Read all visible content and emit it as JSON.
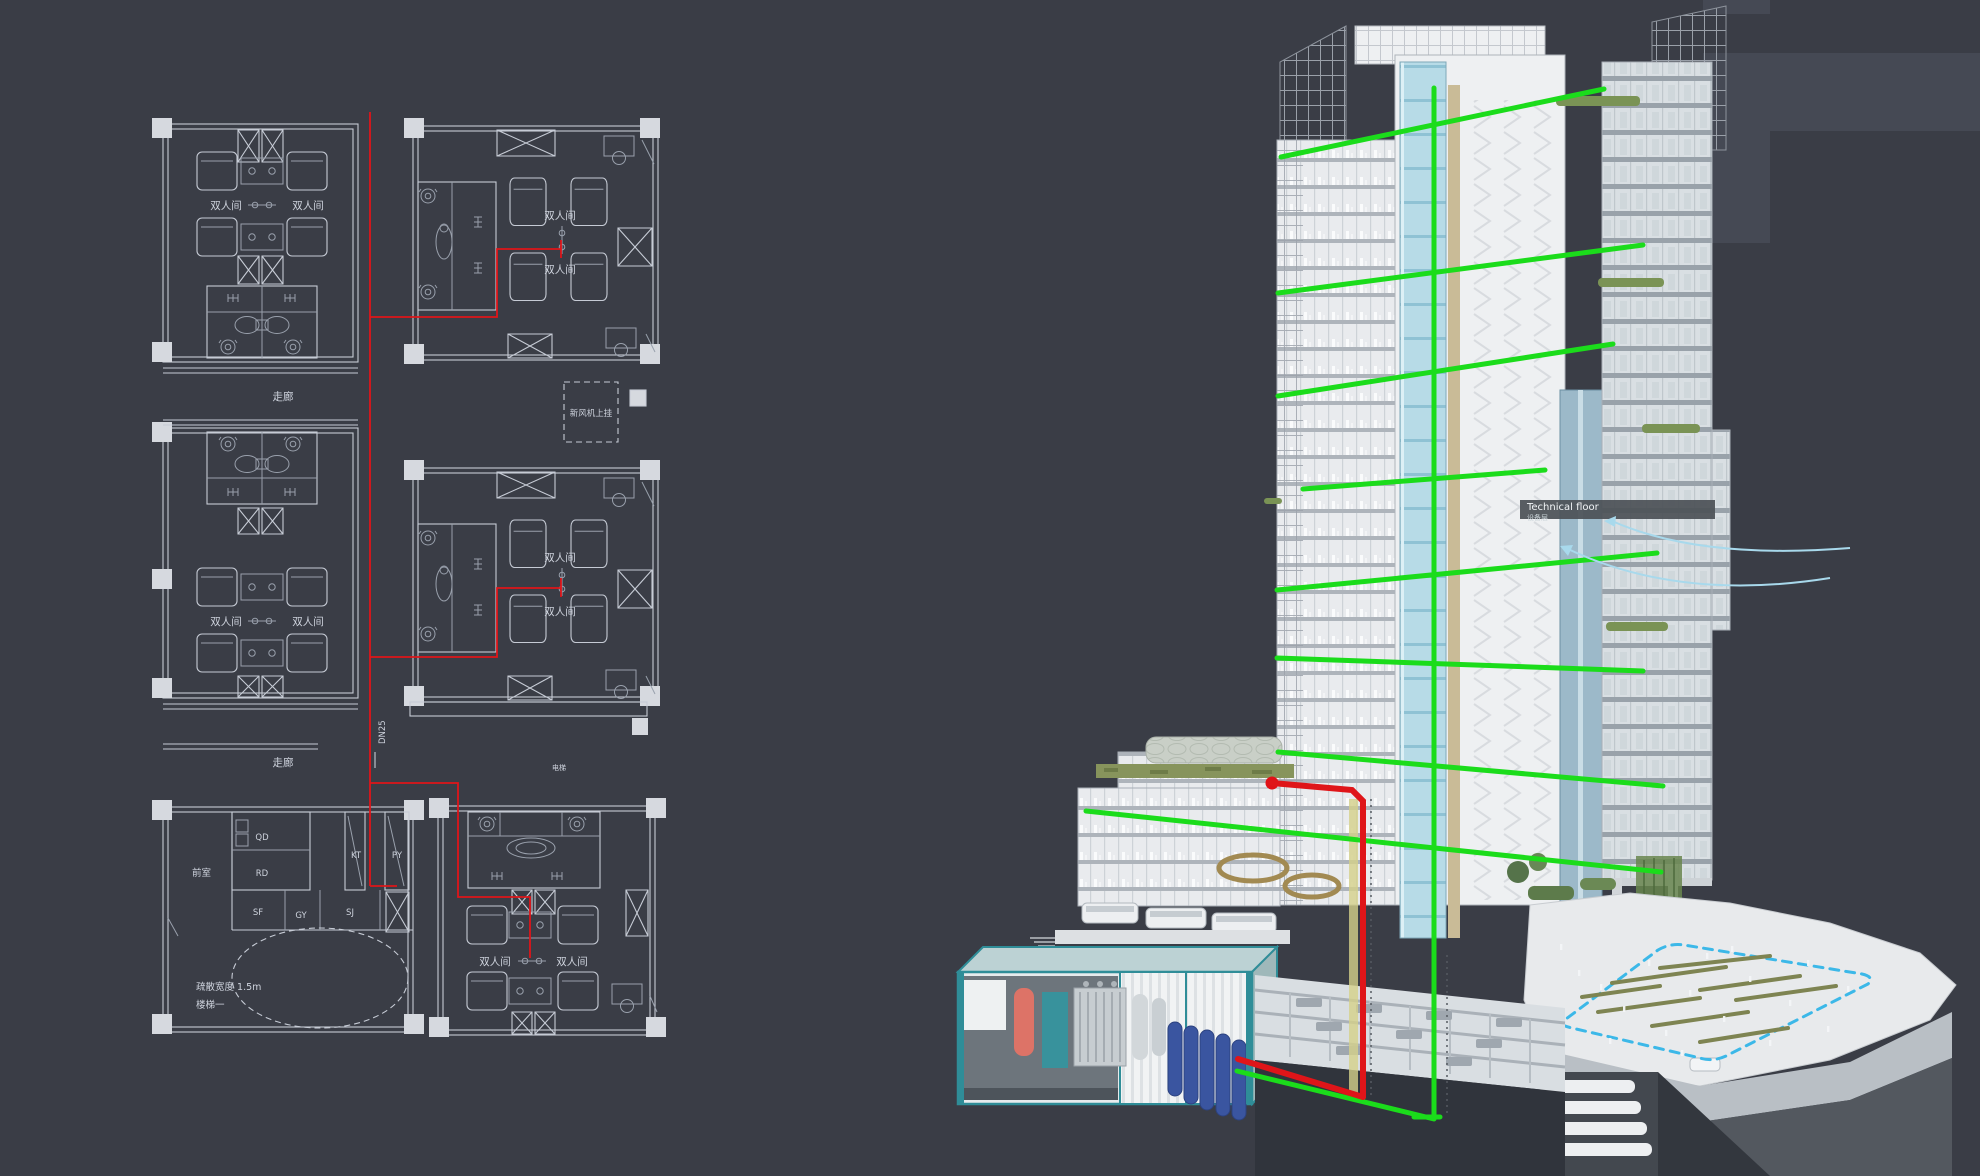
{
  "theme": {
    "bg": "#3a3d46",
    "plan_line": "#c6cbd5",
    "plan_dim": "#99a0ac",
    "plan_fill": "#d6d9df",
    "plan_text": "#ced3dd",
    "pipe_red": "#df1519",
    "pipe_green": "#1bdc1b",
    "boundary_cyan": "#3cb8e8",
    "arrow_blue": "#a8d9ec",
    "bench_olive": "#7e8452",
    "tech_band": "#4c5257",
    "container_teal": "#2f8d98",
    "shaft_blue": "#b9dce8",
    "shaft_yellow": "#d5d18a",
    "tank_red": "#dd7367",
    "cylinder_blue": "#3a55a0"
  },
  "floor_plan": {
    "double_room": "双人间",
    "corridor": "走廊",
    "pipe_size": "DN25",
    "fresh_air": "新风机上挂",
    "evac_width": "疏散宽度 1.5m",
    "stair": "楼梯一",
    "elevator": "电梯",
    "rooms": {
      "front_room": "前室",
      "qd": "QD",
      "rd": "RD",
      "sf": "SF",
      "gy": "GY",
      "sj": "SJ",
      "kt": "KT",
      "py": "PY"
    }
  },
  "building": {
    "technical_floor": "Technical floor",
    "technical_floor_cn": "设备层"
  }
}
